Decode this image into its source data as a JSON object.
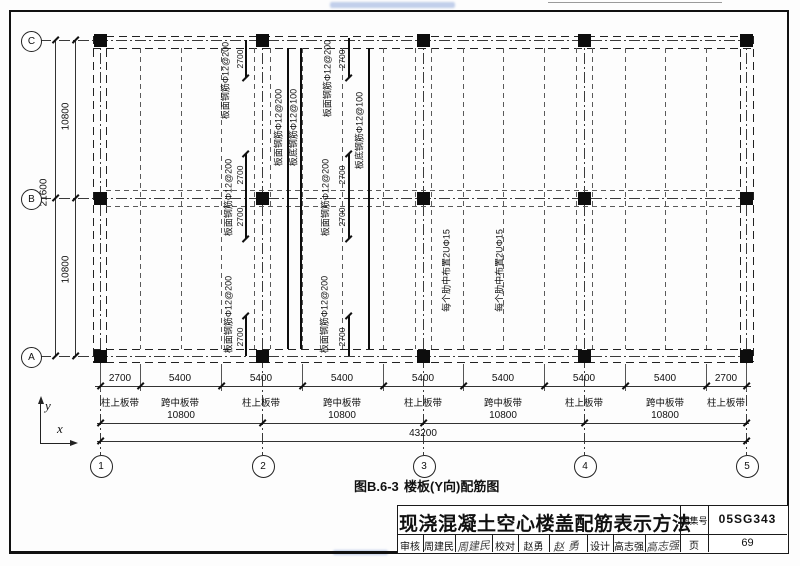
{
  "grid": {
    "cols": [
      "1",
      "2",
      "3",
      "4",
      "5"
    ],
    "rows": [
      "C",
      "B",
      "A"
    ]
  },
  "dims": {
    "b1": [
      "2700",
      "5400",
      "5400",
      "5400",
      "5400",
      "5400",
      "5400",
      "5400",
      "2700"
    ],
    "b2": [
      "10800",
      "10800",
      "10800",
      "10800"
    ],
    "total": "43200",
    "left": [
      "10800",
      "10800"
    ],
    "left_total": "21600"
  },
  "strips": [
    "柱上板带",
    "跨中板带",
    "柱上板带",
    "跨中板带",
    "柱上板带",
    "跨中板带",
    "柱上板带",
    "跨中板带",
    "柱上板带"
  ],
  "labels": {
    "top_rebar": "板面钢筋Φ12@200",
    "bottom_rebar": "板底钢筋Φ12@100",
    "rib_note": "每个肋中布置2UΦ15",
    "d2700": "2700"
  },
  "axis": {
    "x": "x",
    "y": "y"
  },
  "caption": {
    "fig": "图B.6-3",
    "name": "楼板(Y向)配筋图"
  },
  "titleblock": {
    "title": "现浇混凝土空心楼盖配筋表示方法",
    "atlas_label": "图集号",
    "atlas_no": "05SG343",
    "page_label": "页",
    "page_no": "69",
    "reviewer_label": "审核",
    "reviewer": "周建民",
    "reviewer_sig": "周建民",
    "checker_label": "校对",
    "checker": "赵勇",
    "checker_sig": "赵勇",
    "designer_label": "设计",
    "designer": "高志强",
    "designer_sig": "高志强"
  }
}
